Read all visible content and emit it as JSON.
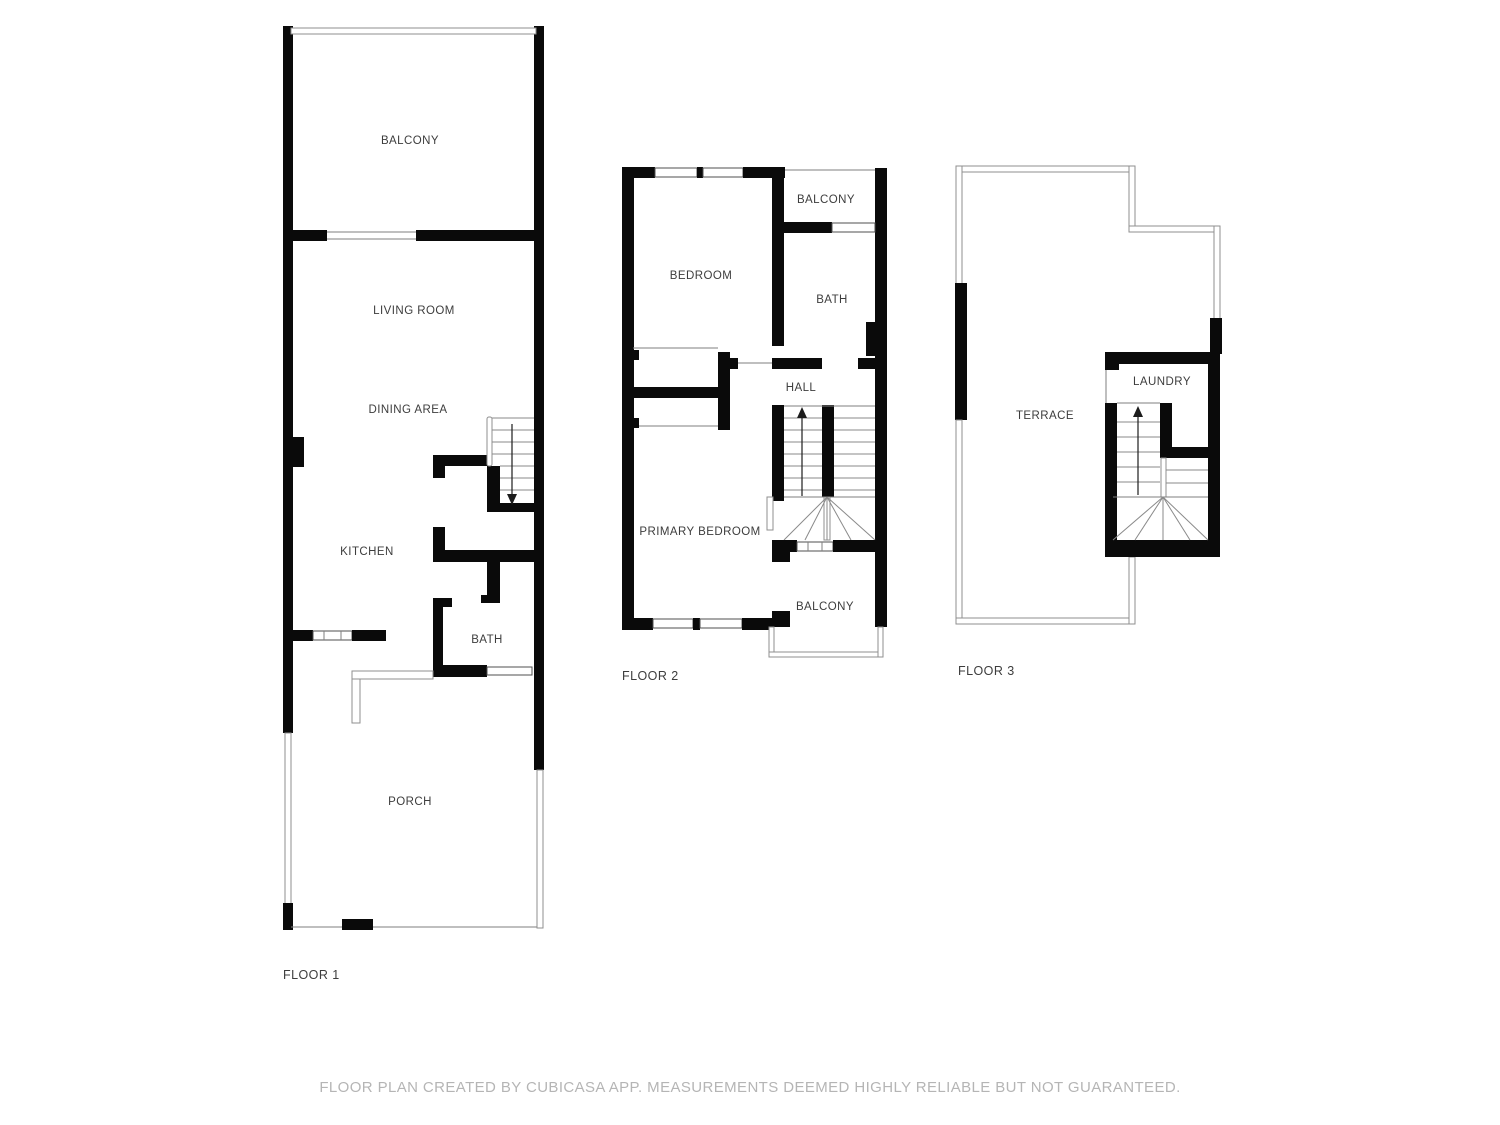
{
  "page": {
    "background": "#ffffff"
  },
  "colors": {
    "wall": "#0a0a0a",
    "label": "#3d3d3d",
    "disclaimer": "#b5b5b5",
    "thin_line": "#7f7f7f",
    "rail_line": "#8f8f8f",
    "win_line": "#4f4f4f"
  },
  "disclaimer": "FLOOR PLAN CREATED BY CUBICASA APP. MEASUREMENTS DEEMED HIGHLY RELIABLE BUT NOT GUARANTEED.",
  "floors": [
    {
      "label": "FLOOR 1",
      "rooms": [
        {
          "name": "BALCONY"
        },
        {
          "name": "LIVING ROOM"
        },
        {
          "name": "DINING AREA"
        },
        {
          "name": "KITCHEN"
        },
        {
          "name": "BATH"
        },
        {
          "name": "PORCH"
        }
      ]
    },
    {
      "label": "FLOOR 2",
      "rooms": [
        {
          "name": "BALCONY"
        },
        {
          "name": "BEDROOM"
        },
        {
          "name": "BATH"
        },
        {
          "name": "HALL"
        },
        {
          "name": "PRIMARY BEDROOM"
        },
        {
          "name": "BALCONY"
        }
      ]
    },
    {
      "label": "FLOOR 3",
      "rooms": [
        {
          "name": "TERRACE"
        },
        {
          "name": "LAUNDRY"
        }
      ]
    }
  ]
}
